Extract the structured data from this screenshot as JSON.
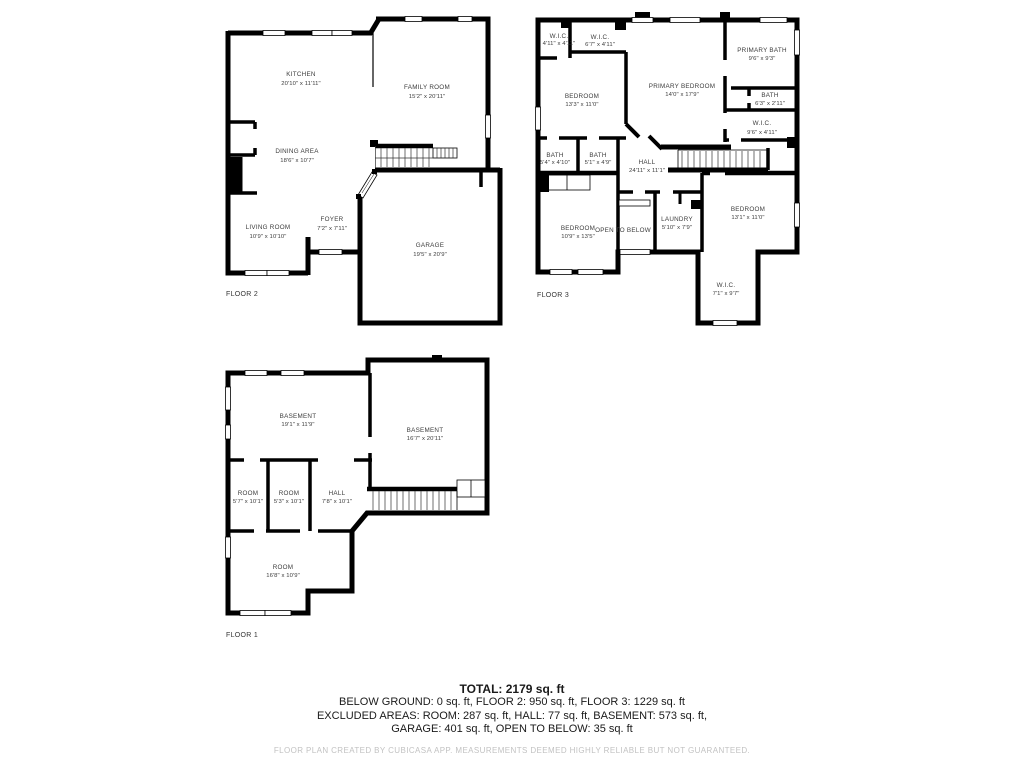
{
  "colors": {
    "wall": "#000000",
    "room_text": "#3c3c3c",
    "summary_text": "#1a1a1a",
    "disclaimer_text": "#c2c2c2"
  },
  "floors": [
    {
      "label": "FLOOR 2",
      "rooms": [
        {
          "name": "KITCHEN",
          "dims": "20'10\" x 11'11\""
        },
        {
          "name": "FAMILY ROOM",
          "dims": "15'2\" x 20'11\""
        },
        {
          "name": "DINING AREA",
          "dims": "18'6\" x 10'7\""
        },
        {
          "name": "LIVING ROOM",
          "dims": "10'9\" x 10'10\""
        },
        {
          "name": "FOYER",
          "dims": "7'2\" x 7'11\""
        },
        {
          "name": "GARAGE",
          "dims": "19'5\" x 20'9\""
        }
      ]
    },
    {
      "label": "FLOOR 3",
      "rooms": [
        {
          "name": "W.I.C.",
          "dims": "4'11\" x 4'11\""
        },
        {
          "name": "W.I.C.",
          "dims": "6'7\" x 4'11\""
        },
        {
          "name": "PRIMARY BATH",
          "dims": "9'6\" x 9'3\""
        },
        {
          "name": "BEDROOM",
          "dims": "13'3\" x 11'0\""
        },
        {
          "name": "PRIMARY BEDROOM",
          "dims": "14'0\" x 17'9\""
        },
        {
          "name": "BATH",
          "dims": "6'3\" x 2'11\""
        },
        {
          "name": "W.I.C.",
          "dims": "9'6\" x 4'11\""
        },
        {
          "name": "BATH",
          "dims": "5'4\" x 4'10\""
        },
        {
          "name": "BATH",
          "dims": "5'1\" x 4'9\""
        },
        {
          "name": "HALL",
          "dims": "24'11\" x 11'1\""
        },
        {
          "name": "BEDROOM",
          "dims": "10'9\" x 13'5\""
        },
        {
          "name": "OPEN TO BELOW",
          "dims": ""
        },
        {
          "name": "LAUNDRY",
          "dims": "5'10\" x 7'9\""
        },
        {
          "name": "BEDROOM",
          "dims": "13'1\" x 11'0\""
        },
        {
          "name": "W.I.C.",
          "dims": "7'1\" x 9'7\""
        }
      ]
    },
    {
      "label": "FLOOR 1",
      "rooms": [
        {
          "name": "BASEMENT",
          "dims": "19'1\" x 11'9\""
        },
        {
          "name": "BASEMENT",
          "dims": "16'7\" x 20'11\""
        },
        {
          "name": "ROOM",
          "dims": "5'7\" x 10'1\""
        },
        {
          "name": "ROOM",
          "dims": "5'3\" x 10'1\""
        },
        {
          "name": "HALL",
          "dims": "7'8\" x 10'1\""
        },
        {
          "name": "ROOM",
          "dims": "16'8\" x 10'9\""
        }
      ]
    }
  ],
  "summary": {
    "total": "TOTAL: 2179 sq. ft",
    "line1": "BELOW GROUND: 0 sq. ft, FLOOR 2: 950 sq. ft, FLOOR 3: 1229 sq. ft",
    "line2": "EXCLUDED AREAS: ROOM: 287 sq. ft, HALL: 77 sq. ft, BASEMENT: 573 sq. ft,",
    "line3": "GARAGE: 401 sq. ft, OPEN TO BELOW: 35 sq. ft",
    "disclaimer": "FLOOR PLAN CREATED BY CUBICASA APP. MEASUREMENTS DEEMED HIGHLY RELIABLE BUT NOT GUARANTEED."
  }
}
